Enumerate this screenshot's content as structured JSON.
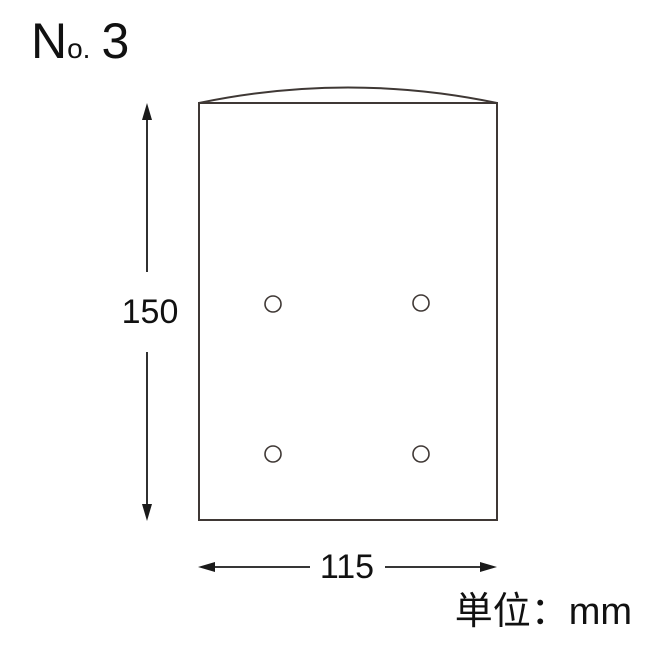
{
  "title": {
    "n": "N",
    "o": "o.",
    "number": "3"
  },
  "diagram": {
    "height_label": "150",
    "width_label": "115",
    "unit_label": "単位：mm",
    "bag": {
      "width_mm": 115,
      "height_mm": 150,
      "holes": [
        {
          "cx": 273,
          "cy": 304
        },
        {
          "cx": 421,
          "cy": 303
        },
        {
          "cx": 273,
          "cy": 454
        },
        {
          "cx": 421,
          "cy": 454
        }
      ],
      "hole_radius": 8
    }
  },
  "colors": {
    "outline": "#3f3835",
    "dimension": "#1a1a1a",
    "text": "#111111",
    "background": "#ffffff"
  }
}
